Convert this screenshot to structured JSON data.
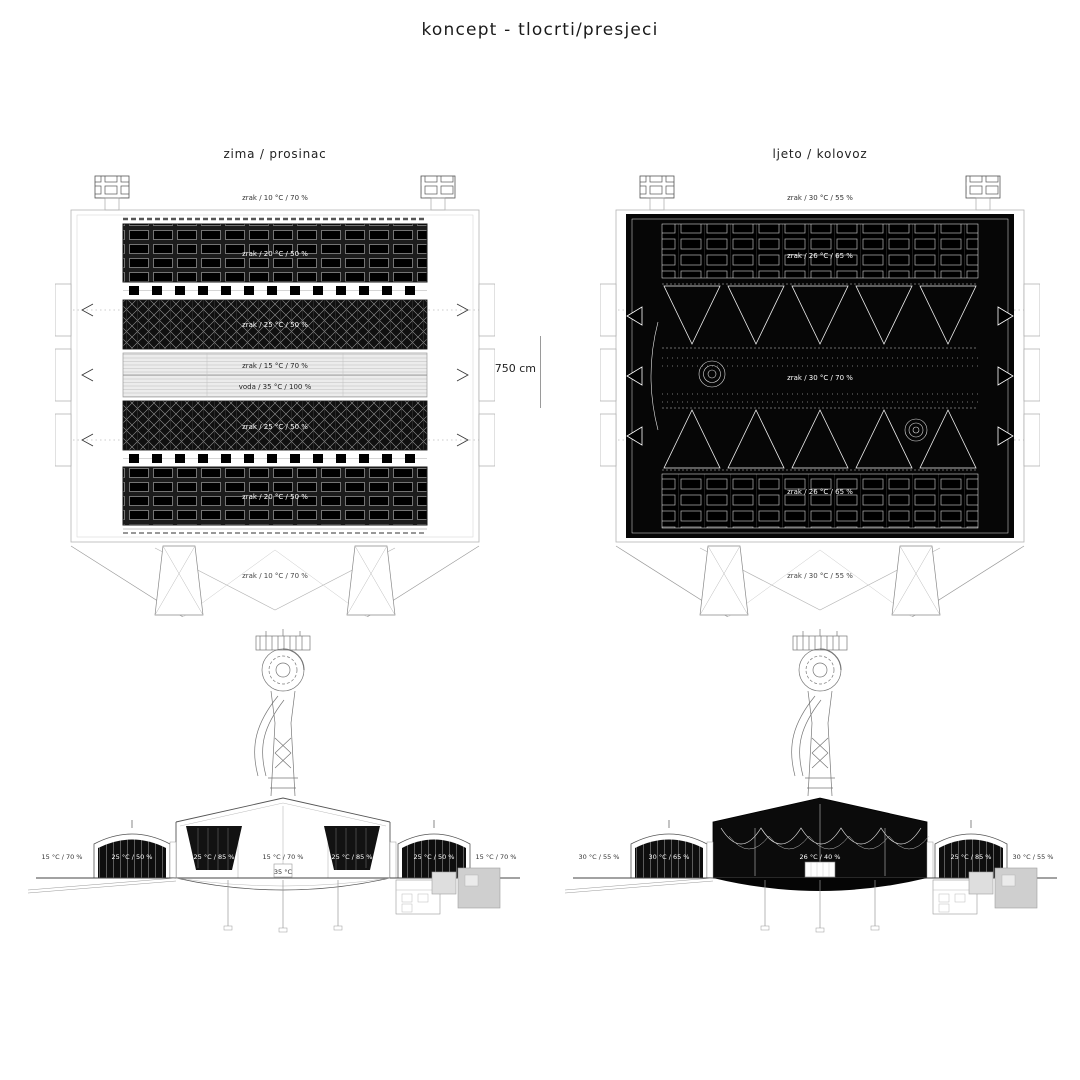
{
  "page": {
    "title": "koncept - tlocrti/presjeci"
  },
  "scale": {
    "label": "750 cm"
  },
  "plans": {
    "winter": {
      "title": "zima / prosinac",
      "label_top": "zrak / 10 °C / 70 %",
      "label_hall_top": "zrak / 20 °C / 50 %",
      "label_green_top": "zrak / 25 °C / 50 %",
      "label_center_air": "zrak / 15 °C / 70 %",
      "label_center_water": "voda / 35 °C / 100 %",
      "label_green_bottom": "zrak / 25 °C / 50 %",
      "label_hall_bottom": "zrak / 20 °C / 50 %",
      "label_bottom": "zrak / 10 °C / 70 %"
    },
    "summer": {
      "title": "ljeto / kolovoz",
      "label_top": "zrak / 30 °C / 55 %",
      "label_hall_top": "zrak / 26 °C / 65 %",
      "label_center": "zrak / 30 °C / 70 %",
      "label_hall_bottom": "zrak / 26 °C / 65 %",
      "label_bottom": "zrak / 30 °C / 55 %"
    }
  },
  "sections": {
    "winter": {
      "labels": [
        "15 °C / 70 %",
        "25 °C / 50 %",
        "25 °C / 85 %",
        "15 °C / 70 %",
        "25 °C / 85 %",
        "25 °C / 50 %",
        "15 °C / 70 %"
      ],
      "label_water": "35 °C"
    },
    "summer": {
      "labels": [
        "30 °C / 55 %",
        "30 °C / 65 %",
        "26 °C / 40 %",
        "25 °C / 85 %",
        "30 °C / 55 %"
      ]
    }
  },
  "colors": {
    "ink": "#111111",
    "line": "#999999",
    "fill_dark": "#0b0b0b",
    "fill_light": "#ececec",
    "annex_gray": "#cfcfcf"
  }
}
